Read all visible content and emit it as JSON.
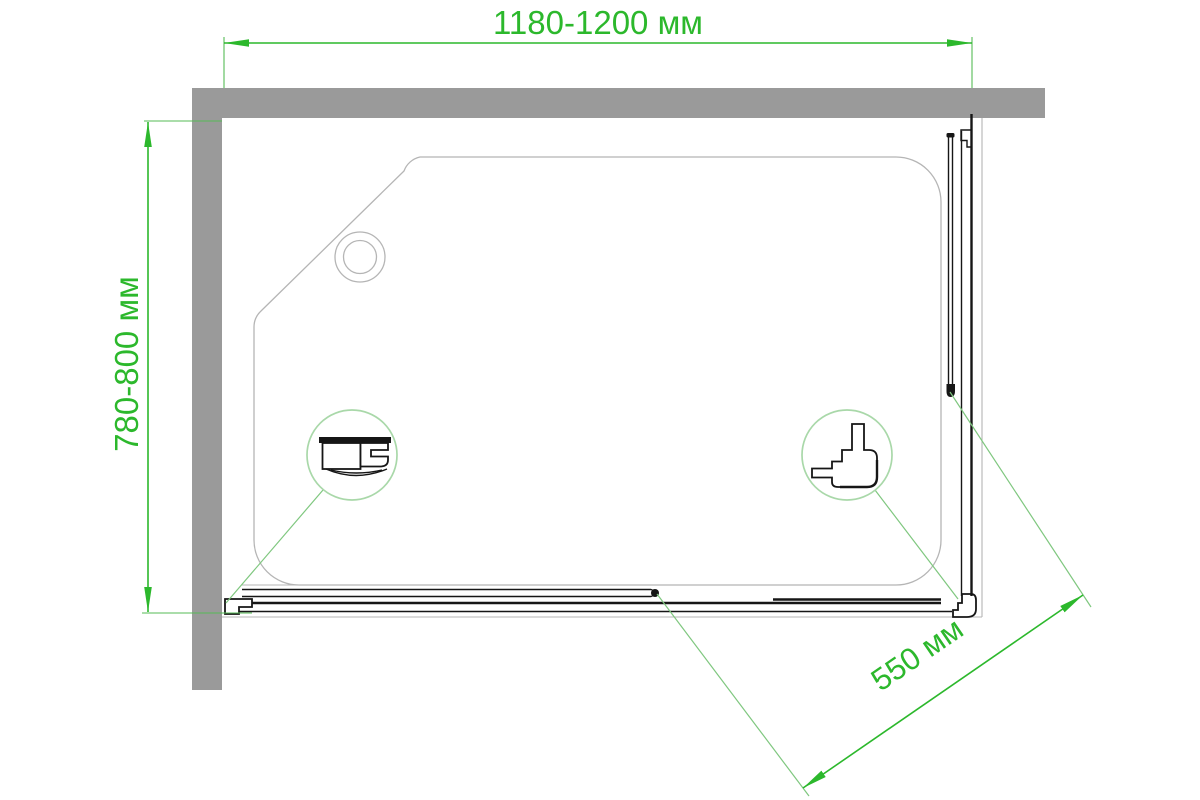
{
  "title": "Shower enclosure technical drawing (top view)",
  "labels": {
    "width": "1180-1200 мм",
    "depth": "780-800 мм",
    "door": "550 мм"
  },
  "colors": {
    "dimension": "#2cb82c",
    "extension": "#55bb55",
    "leader": "#7fc77f",
    "detail_circle": "#a9d8a9",
    "wall": "#9a9a9a",
    "outline": "#b5b5b5",
    "profile": "#161616",
    "background": "#ffffff"
  }
}
